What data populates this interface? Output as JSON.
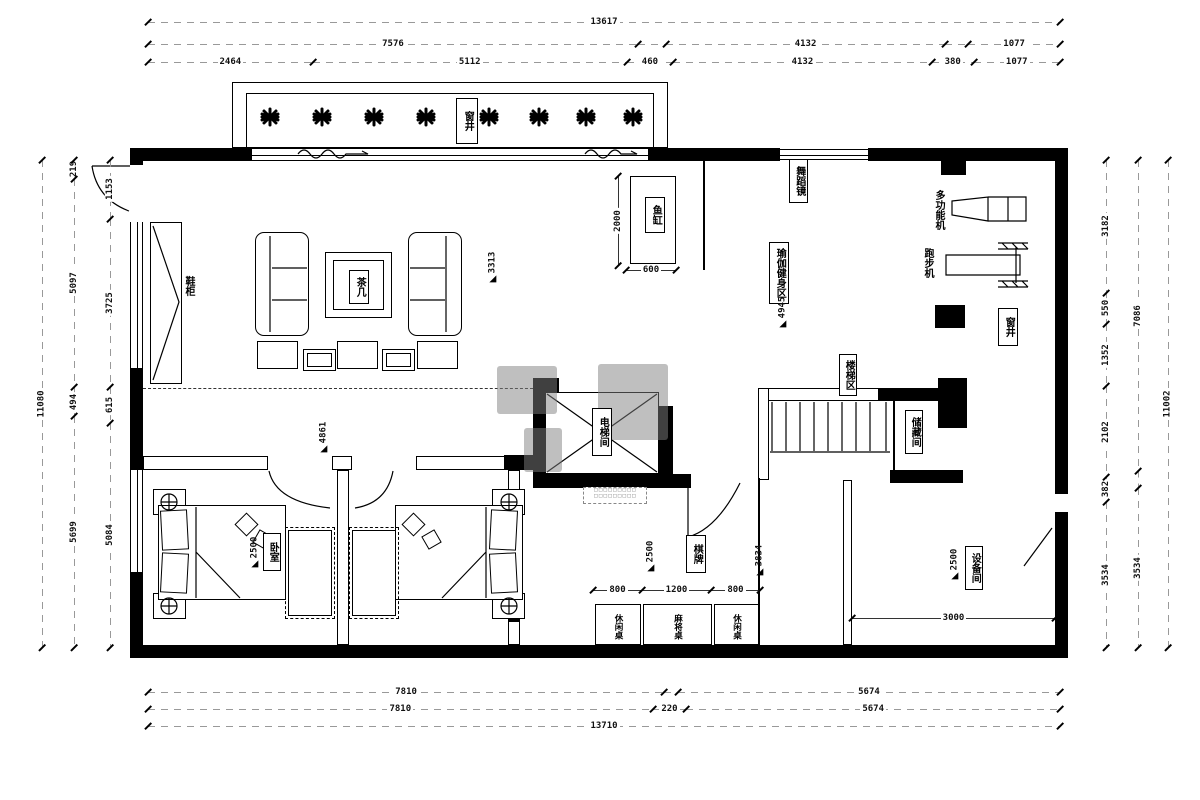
{
  "chains": {
    "top_overall": {
      "values": [
        13617
      ],
      "labels": [
        "13617"
      ]
    },
    "top_mid": {
      "values": [
        7576,
        460,
        4132,
        380,
        1077
      ],
      "labels": [
        "7576",
        "",
        "4132",
        "",
        "1077"
      ]
    },
    "top_detail": {
      "values": [
        2464,
        5112,
        460,
        4132,
        380,
        1077
      ],
      "labels": [
        "2464",
        "5112",
        "460",
        "4132",
        "380",
        "1077"
      ]
    },
    "bottom_inner": {
      "values": [
        7810,
        220,
        5674
      ],
      "labels": [
        "7810",
        "",
        "5674"
      ]
    },
    "bottom_mid": {
      "values": [
        7810,
        220,
        5674
      ],
      "labels": [
        "7810",
        "220",
        "5674"
      ]
    },
    "bottom_overall": {
      "values": [
        13710
      ],
      "labels": [
        "13710"
      ]
    },
    "left_inner": {
      "values": [
        1153,
        3725,
        615,
        5084
      ],
      "labels": [
        "1153",
        "3725",
        "615",
        "5084"
      ]
    },
    "left_mid": {
      "values": [
        219,
        5097,
        494,
        5699
      ],
      "labels": [
        "219",
        "5097",
        "494",
        "5699"
      ]
    },
    "left_overall": {
      "values": [
        11080
      ],
      "labels": [
        "11080"
      ]
    },
    "right_inner": {
      "values": [
        3182,
        550,
        1352,
        2102,
        382,
        3534
      ],
      "labels": [
        "3182",
        "550",
        "1352",
        "2102",
        "382",
        "3534"
      ]
    },
    "right_mid": {
      "values": [
        7086,
        382,
        3534
      ],
      "labels": [
        "7086",
        "",
        "3534"
      ]
    },
    "right_overall": {
      "values": [
        11002
      ],
      "labels": [
        "11002"
      ]
    },
    "tables": {
      "values": [
        800,
        1200,
        800
      ],
      "labels": [
        "800",
        "1200",
        "800"
      ]
    },
    "fish_height": {
      "values": [
        2000
      ],
      "labels": [
        "2000"
      ]
    },
    "fish_width": {
      "values": [
        600
      ],
      "labels": [
        "600"
      ]
    },
    "right_room_width": {
      "values": [
        3000
      ],
      "labels": [
        "3000"
      ]
    }
  },
  "rooms": {
    "planter_label": "窗井",
    "window_well": "窗井",
    "elevator": "电梯间",
    "stairs": "楼梯区",
    "storage": "储藏间",
    "yoga": "瑜伽健身区",
    "bedroom": "卧室",
    "chess": "棋牌",
    "equipment": "设备间"
  },
  "furniture": {
    "shoe_cabinet": "鞋柜",
    "tea_table": "茶几",
    "fish_tank": "鱼缸",
    "mirror": "舞蹈镜",
    "multi_gym": "多功能机",
    "treadmill": "跑步机",
    "table_left": "休闲桌",
    "table_mid": "麻将桌",
    "table_right": "休闲桌"
  },
  "annotations": {
    "living": "3313",
    "yoga": "4945",
    "corridor": "4861",
    "hall": "3834",
    "bedroom": "2500",
    "chess": "2500",
    "equipment": "2500"
  },
  "note": "□□□□□□□□□"
}
